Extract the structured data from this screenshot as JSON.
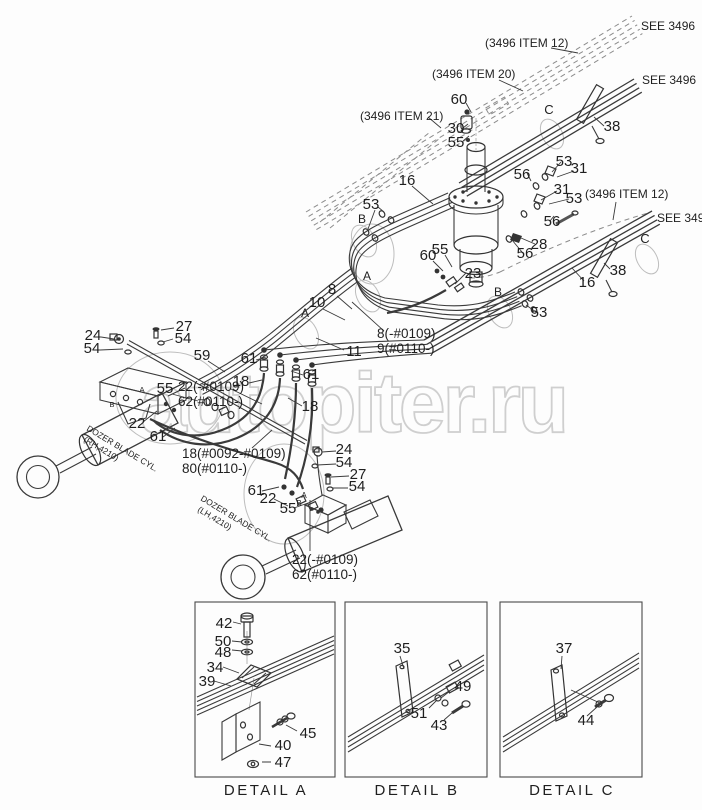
{
  "watermark": {
    "text": "autopiter.ru",
    "color": "#cfcfcf"
  },
  "diagram": {
    "labels": [
      {
        "n": "see-3496-1",
        "t": "SEE 3496",
        "x": 641,
        "y": 30,
        "fs": 12,
        "a": "s"
      },
      {
        "n": "ref-3496-item12-top",
        "t": "(3496 ITEM 12)",
        "x": 485,
        "y": 47,
        "fs": 12,
        "a": "s"
      },
      {
        "n": "ref-3496-item20",
        "t": "(3496 ITEM 20)",
        "x": 432,
        "y": 78,
        "fs": 12,
        "a": "s"
      },
      {
        "n": "see-3496-2",
        "t": "SEE 3496",
        "x": 642,
        "y": 84,
        "fs": 12,
        "a": "s"
      },
      {
        "n": "ref-3496-item21",
        "t": "(3496 ITEM 21)",
        "x": 360,
        "y": 120,
        "fs": 12,
        "a": "s"
      },
      {
        "n": "ref-3496-item12-mid",
        "t": "(3496 ITEM 12)",
        "x": 585,
        "y": 198,
        "fs": 12,
        "a": "s"
      },
      {
        "n": "see-3496-3",
        "t": "SEE 3496",
        "x": 657,
        "y": 222,
        "fs": 12,
        "a": "s"
      },
      {
        "n": "60-top",
        "t": "60",
        "x": 459,
        "y": 104
      },
      {
        "n": "30",
        "t": "30",
        "x": 456,
        "y": 133
      },
      {
        "n": "55-top",
        "t": "55",
        "x": 456,
        "y": 147
      },
      {
        "n": "flow-c-1",
        "t": "C",
        "x": 549,
        "y": 114,
        "fs": 13
      },
      {
        "n": "38-top",
        "t": "38",
        "x": 612,
        "y": 131
      },
      {
        "n": "16-left",
        "t": "16",
        "x": 407,
        "y": 185
      },
      {
        "n": "53-left",
        "t": "53",
        "x": 371,
        "y": 209
      },
      {
        "n": "flow-b-1",
        "t": "B",
        "x": 362,
        "y": 223,
        "fs": 12
      },
      {
        "n": "56-a",
        "t": "56",
        "x": 522,
        "y": 179
      },
      {
        "n": "53-a",
        "t": "53",
        "x": 564,
        "y": 166
      },
      {
        "n": "31-a",
        "t": "31",
        "x": 579,
        "y": 173
      },
      {
        "n": "31-b",
        "t": "31",
        "x": 562,
        "y": 194
      },
      {
        "n": "53-b",
        "t": "53",
        "x": 574,
        "y": 203
      },
      {
        "n": "56-b",
        "t": "56",
        "x": 552,
        "y": 226
      },
      {
        "n": "56-c",
        "t": "56",
        "x": 525,
        "y": 258
      },
      {
        "n": "28",
        "t": "28",
        "x": 539,
        "y": 249
      },
      {
        "n": "16-right",
        "t": "16",
        "x": 587,
        "y": 287
      },
      {
        "n": "38-mid",
        "t": "38",
        "x": 618,
        "y": 275
      },
      {
        "n": "flow-c-2",
        "t": "C",
        "x": 645,
        "y": 243,
        "fs": 13
      },
      {
        "n": "53-c",
        "t": "53",
        "x": 539,
        "y": 317
      },
      {
        "n": "flow-b-2",
        "t": "B",
        "x": 498,
        "y": 296,
        "fs": 12
      },
      {
        "n": "60-mid",
        "t": "60",
        "x": 428,
        "y": 260
      },
      {
        "n": "55-mid",
        "t": "55",
        "x": 440,
        "y": 254
      },
      {
        "n": "23",
        "t": "23",
        "x": 473,
        "y": 278
      },
      {
        "n": "flow-a-1",
        "t": "A",
        "x": 367,
        "y": 280,
        "fs": 12
      },
      {
        "n": "flow-a-2",
        "t": "A",
        "x": 305,
        "y": 317,
        "fs": 12
      },
      {
        "n": "8",
        "t": "8",
        "x": 332,
        "y": 294
      },
      {
        "n": "10",
        "t": "10",
        "x": 317,
        "y": 307
      },
      {
        "n": "11",
        "t": "11",
        "x": 354,
        "y": 356
      },
      {
        "n": "8-variant",
        "t": "8(-#0109)",
        "x": 377,
        "y": 338,
        "fs": 13.5,
        "a": "s"
      },
      {
        "n": "9-variant",
        "t": "9(#0110-)",
        "x": 377,
        "y": 353,
        "fs": 13.5,
        "a": "s"
      },
      {
        "n": "24-left",
        "t": "24",
        "x": 93,
        "y": 340
      },
      {
        "n": "54-left-1",
        "t": "54",
        "x": 92,
        "y": 353
      },
      {
        "n": "27-left",
        "t": "27",
        "x": 184,
        "y": 331
      },
      {
        "n": "54-left-2",
        "t": "54",
        "x": 183,
        "y": 343
      },
      {
        "n": "59",
        "t": "59",
        "x": 202,
        "y": 360
      },
      {
        "n": "61-a",
        "t": "61",
        "x": 249,
        "y": 363
      },
      {
        "n": "18-a",
        "t": "18",
        "x": 241,
        "y": 386
      },
      {
        "n": "55-left",
        "t": "55",
        "x": 165,
        "y": 393
      },
      {
        "n": "22-variant-left",
        "t": "22(-#0109)",
        "x": 178,
        "y": 391,
        "fs": 13.5,
        "a": "s"
      },
      {
        "n": "62-variant-left",
        "t": "62(#0110-)",
        "x": 178,
        "y": 406,
        "fs": 13.5,
        "a": "s"
      },
      {
        "n": "22-left",
        "t": "22",
        "x": 137,
        "y": 428
      },
      {
        "n": "61-b",
        "t": "61",
        "x": 158,
        "y": 441
      },
      {
        "n": "61-c",
        "t": "61",
        "x": 311,
        "y": 379
      },
      {
        "n": "18-b",
        "t": "18",
        "x": 310,
        "y": 411
      },
      {
        "n": "18-variant",
        "t": "18(#0092-#0109)",
        "x": 182,
        "y": 458,
        "fs": 13.5,
        "a": "s"
      },
      {
        "n": "80-variant",
        "t": "80(#0110-)",
        "x": 182,
        "y": 473,
        "fs": 13.5,
        "a": "s"
      },
      {
        "n": "24-bot",
        "t": "24",
        "x": 344,
        "y": 454
      },
      {
        "n": "54-bot-1",
        "t": "54",
        "x": 344,
        "y": 467
      },
      {
        "n": "27-bot",
        "t": "27",
        "x": 358,
        "y": 479
      },
      {
        "n": "54-bot-2",
        "t": "54",
        "x": 357,
        "y": 491
      },
      {
        "n": "61-d",
        "t": "61",
        "x": 256,
        "y": 495
      },
      {
        "n": "22-bot",
        "t": "22",
        "x": 268,
        "y": 503
      },
      {
        "n": "55-bot",
        "t": "55",
        "x": 288,
        "y": 513
      },
      {
        "n": "port-a-bot",
        "t": "A",
        "x": 304,
        "y": 498,
        "fs": 8
      },
      {
        "n": "port-b-bot",
        "t": "B",
        "x": 299,
        "y": 506,
        "fs": 8
      },
      {
        "n": "22-variant-bot",
        "t": "22(-#0109)",
        "x": 292,
        "y": 564,
        "fs": 13.5,
        "a": "s"
      },
      {
        "n": "62-variant-bot",
        "t": "62(#0110-)",
        "x": 292,
        "y": 579,
        "fs": 13.5,
        "a": "s"
      },
      {
        "n": "port-a-block",
        "t": "A",
        "x": 142,
        "y": 392,
        "fs": 7.5
      },
      {
        "n": "port-b-block",
        "t": "B",
        "x": 112,
        "y": 407,
        "fs": 7.5
      },
      {
        "n": "cyl-rh-name",
        "t": "DOZER BLADE CYL.",
        "x": 86,
        "y": 430,
        "fs": 8.5,
        "a": "s",
        "r": 31
      },
      {
        "n": "cyl-rh-code",
        "t": "(RH,4210)",
        "x": 83,
        "y": 441,
        "fs": 8.5,
        "a": "s",
        "r": 31
      },
      {
        "n": "cyl-lh-name",
        "t": "DOZER BLADE CYL.",
        "x": 200,
        "y": 500,
        "fs": 8.5,
        "a": "s",
        "r": 31
      },
      {
        "n": "cyl-lh-code",
        "t": "(LH,4210)",
        "x": 197,
        "y": 511,
        "fs": 8.5,
        "a": "s",
        "r": 31
      },
      {
        "n": "42",
        "t": "42",
        "x": 224,
        "y": 628
      },
      {
        "n": "50",
        "t": "50",
        "x": 223,
        "y": 646
      },
      {
        "n": "48",
        "t": "48",
        "x": 223,
        "y": 657
      },
      {
        "n": "34",
        "t": "34",
        "x": 215,
        "y": 672
      },
      {
        "n": "39",
        "t": "39",
        "x": 207,
        "y": 686
      },
      {
        "n": "45",
        "t": "45",
        "x": 308,
        "y": 738
      },
      {
        "n": "40",
        "t": "40",
        "x": 283,
        "y": 750
      },
      {
        "n": "47",
        "t": "47",
        "x": 283,
        "y": 767
      },
      {
        "n": "detail-a-caption",
        "t": "DETAIL A",
        "x": 266,
        "y": 795,
        "fs": 15,
        "cls": "cap"
      },
      {
        "n": "35",
        "t": "35",
        "x": 402,
        "y": 653
      },
      {
        "n": "49",
        "t": "49",
        "x": 463,
        "y": 691
      },
      {
        "n": "51",
        "t": "51",
        "x": 419,
        "y": 718
      },
      {
        "n": "43",
        "t": "43",
        "x": 439,
        "y": 730
      },
      {
        "n": "detail-b-caption",
        "t": "DETAIL B",
        "x": 417,
        "y": 795,
        "fs": 15,
        "cls": "cap"
      },
      {
        "n": "37",
        "t": "37",
        "x": 564,
        "y": 653
      },
      {
        "n": "44",
        "t": "44",
        "x": 586,
        "y": 725
      },
      {
        "n": "detail-c-caption",
        "t": "DETAIL C",
        "x": 572,
        "y": 795,
        "fs": 15,
        "cls": "cap"
      }
    ]
  }
}
